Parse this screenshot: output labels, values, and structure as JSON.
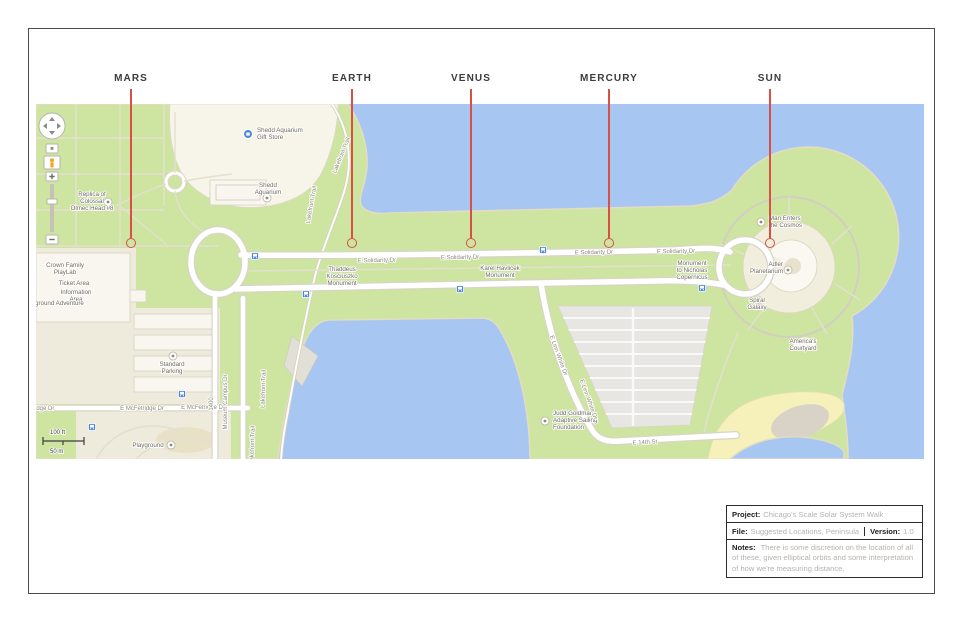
{
  "colors": {
    "water": "#a7c7f2",
    "park": "#cde5a1",
    "land_beige": "#efebdc",
    "building": "#f8f6ee",
    "road": "#ffffff",
    "road_casing": "#d8d4c6",
    "path": "#e3e0d0",
    "parking": "#e7e6e2",
    "stripe": "#f9f9f7",
    "beach": "#f6f0ba",
    "sand_patch": "#d8d3c6",
    "shore": "#e3dcc0",
    "plaza": "#f2eede",
    "transit": "#4a86d8",
    "pegman": "#f5a623",
    "red": "#d94f44",
    "label": "#6e6a5f",
    "road_label": "#8d897c",
    "frame": "#4a4a4a",
    "title_label": "#1d1d1d",
    "title_value": "#b6b3ae"
  },
  "planets": {
    "items": [
      {
        "label": "MARS",
        "x": 131
      },
      {
        "label": "EARTH",
        "x": 352
      },
      {
        "label": "VENUS",
        "x": 471
      },
      {
        "label": "MERCURY",
        "x": 609
      },
      {
        "label": "SUN",
        "x": 770
      }
    ]
  },
  "title_block": {
    "project_label": "Project:",
    "project_value": "Chicago's Scale Solar System Walk",
    "file_label": "File:",
    "file_value": "Suggested Locations, Peninsula",
    "version_label": "Version:",
    "version_value": "1.0",
    "notes_label": "Notes:",
    "notes_value": "There is some discretion on the location of all of these, given elliptical orbits and some interpretation of how we're measuring distance."
  },
  "map": {
    "scale_bar": {
      "ft": "100 ft",
      "m": "50 m"
    },
    "labels": [
      {
        "lines": [
          "Shedd Aquarium",
          "Gift Store"
        ],
        "x": 221,
        "y": 28,
        "anchor": "start",
        "cls": "poi"
      },
      {
        "lines": [
          "Shedd",
          "Aquarium"
        ],
        "x": 232,
        "y": 83,
        "anchor": "middle",
        "cls": "poi"
      },
      {
        "lines": [
          "Replica of",
          "Colossal",
          "Olmec Head #8"
        ],
        "x": 56,
        "y": 92,
        "anchor": "middle",
        "cls": "poi"
      },
      {
        "lines": [
          "Crown Family",
          "PlayLab"
        ],
        "x": 29,
        "y": 163,
        "anchor": "middle",
        "cls": "poi"
      },
      {
        "lines": [
          "Ticket Area"
        ],
        "x": 38,
        "y": 181,
        "anchor": "middle",
        "cls": "poi"
      },
      {
        "lines": [
          "Information",
          "Area"
        ],
        "x": 40,
        "y": 190,
        "anchor": "middle",
        "cls": "poi"
      },
      {
        "lines": [
          "ground Adventure"
        ],
        "x": -1,
        "y": 201,
        "anchor": "start",
        "cls": "poi"
      },
      {
        "lines": [
          "Standard",
          "Parking"
        ],
        "x": 136,
        "y": 262,
        "anchor": "middle",
        "cls": "poi"
      },
      {
        "lines": [
          "idge Dr"
        ],
        "x": -1,
        "y": 306,
        "anchor": "start",
        "cls": "road"
      },
      {
        "lines": [
          "E McFetridge Dr"
        ],
        "x": 106,
        "y": 306,
        "anchor": "middle",
        "cls": "road"
      },
      {
        "lines": [
          "E McFetridge Dr"
        ],
        "x": 167,
        "y": 305,
        "anchor": "middle",
        "cls": "road"
      },
      {
        "lines": [
          "Playground"
        ],
        "x": 112,
        "y": 343,
        "anchor": "middle",
        "cls": "poi"
      },
      {
        "lines": [
          "Museum Campus Dr"
        ],
        "x": 191,
        "y": 298,
        "anchor": "middle",
        "rot": -90,
        "cls": "road"
      },
      {
        "lines": [
          "1400"
        ],
        "x": 177,
        "y": 300,
        "anchor": "middle",
        "rot": -90,
        "cls": "road"
      },
      {
        "lines": [
          "Lakefront Trail"
        ],
        "x": 307,
        "y": 52,
        "anchor": "middle",
        "rot": -68,
        "cls": "path"
      },
      {
        "lines": [
          "Lakefront Trail"
        ],
        "x": 277,
        "y": 101,
        "anchor": "middle",
        "rot": -80,
        "cls": "path"
      },
      {
        "lines": [
          "Lakefront Trail"
        ],
        "x": 229,
        "y": 285,
        "anchor": "middle",
        "rot": -88,
        "cls": "path"
      },
      {
        "lines": [
          "Lakefront Trail"
        ],
        "x": 218,
        "y": 341,
        "anchor": "middle",
        "rot": -88,
        "cls": "path"
      },
      {
        "lines": [
          "E Solidarity Dr"
        ],
        "x": 341,
        "y": 158,
        "anchor": "middle",
        "rot": -1,
        "cls": "road"
      },
      {
        "lines": [
          "E Solidarity Dr"
        ],
        "x": 424,
        "y": 155,
        "anchor": "middle",
        "rot": -1,
        "cls": "road"
      },
      {
        "lines": [
          "E Solidarity Dr"
        ],
        "x": 558,
        "y": 150,
        "anchor": "middle",
        "rot": -1,
        "cls": "road"
      },
      {
        "lines": [
          "E Solidarity Dr"
        ],
        "x": 640,
        "y": 149,
        "anchor": "middle",
        "rot": -1,
        "cls": "road"
      },
      {
        "lines": [
          "Thaddeus",
          "Kosciuszko",
          "Monument"
        ],
        "x": 306,
        "y": 167,
        "anchor": "middle",
        "cls": "poi"
      },
      {
        "lines": [
          "Karel Havlicek",
          "Monument"
        ],
        "x": 464,
        "y": 166,
        "anchor": "middle",
        "cls": "poi"
      },
      {
        "lines": [
          "Monument",
          "to Nicholas",
          "Copernicus"
        ],
        "x": 656,
        "y": 161,
        "anchor": "middle",
        "cls": "poi"
      },
      {
        "lines": [
          "Man Enters",
          "the Cosmos"
        ],
        "x": 733,
        "y": 116,
        "anchor": "start",
        "cls": "poi"
      },
      {
        "lines": [
          "Adler",
          "Planetarium"
        ],
        "x": 747,
        "y": 162,
        "anchor": "end",
        "cls": "poi"
      },
      {
        "lines": [
          "Spiral",
          "Galaxy"
        ],
        "x": 721,
        "y": 198,
        "anchor": "middle",
        "cls": "poi"
      },
      {
        "lines": [
          "America's",
          "Courtyard"
        ],
        "x": 767,
        "y": 239,
        "anchor": "middle",
        "cls": "poi"
      },
      {
        "lines": [
          "Judd Goldman",
          "Adaptive Sailing",
          "Foundation"
        ],
        "x": 517,
        "y": 311,
        "anchor": "start",
        "cls": "poi"
      },
      {
        "lines": [
          "E 14th St"
        ],
        "x": 609,
        "y": 340,
        "anchor": "middle",
        "rot": -3,
        "cls": "road"
      },
      {
        "lines": [
          "E Linn White Dr"
        ],
        "x": 521,
        "y": 252,
        "anchor": "middle",
        "rot": 70,
        "cls": "road"
      },
      {
        "lines": [
          "E Linn White Dr"
        ],
        "x": 551,
        "y": 296,
        "anchor": "middle",
        "rot": 70,
        "cls": "road"
      }
    ],
    "poi_icons": [
      {
        "x": 72,
        "y": 98
      },
      {
        "x": 231,
        "y": 94
      },
      {
        "x": 137,
        "y": 252
      },
      {
        "x": 135,
        "y": 341
      },
      {
        "x": 509,
        "y": 317
      },
      {
        "x": 725,
        "y": 118
      },
      {
        "x": 752,
        "y": 166
      }
    ],
    "shop_icon": {
      "x": 212,
      "y": 30
    },
    "bus_stops": [
      {
        "x": 219,
        "y": 152
      },
      {
        "x": 270,
        "y": 190
      },
      {
        "x": 507,
        "y": 146
      },
      {
        "x": 424,
        "y": 185
      },
      {
        "x": 666,
        "y": 184
      },
      {
        "x": 146,
        "y": 290
      },
      {
        "x": 56,
        "y": 323
      }
    ]
  }
}
